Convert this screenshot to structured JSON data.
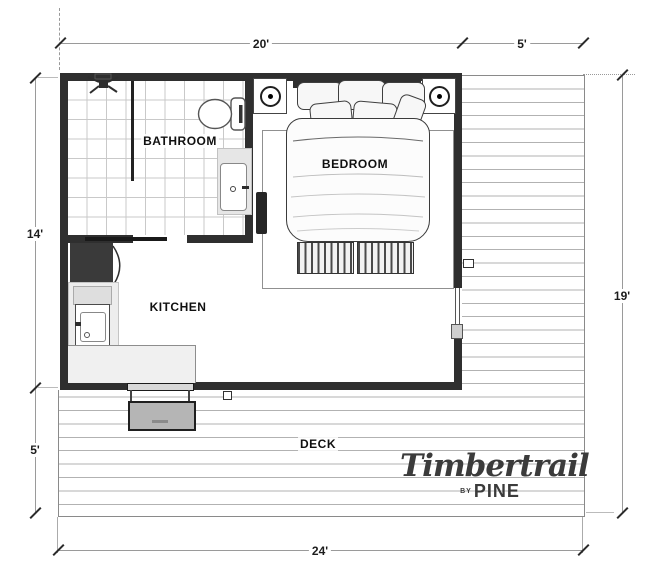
{
  "rooms": {
    "bathroom": "BATHROOM",
    "bedroom": "BEDROOM",
    "kitchen": "KITCHEN",
    "deck": "DECK"
  },
  "dimensions": {
    "top_width": "20'",
    "top_deck_width": "5'",
    "left_height": "14'",
    "left_deck_height": "5'",
    "right_height": "19'",
    "bottom_width": "24'"
  },
  "logo": {
    "brand": "Timbertrail",
    "by_label": "BY",
    "maker": "PINE"
  },
  "icons": {
    "shower": "shower-head-icon",
    "toilet": "toilet-icon",
    "bathroom_sink": "bathroom-sink-icon",
    "kitchen_sink": "kitchen-sink-icon",
    "refrigerator": "refrigerator",
    "bed": "double-bed",
    "lamp": "bedside-lamp-icon",
    "step": "entry-step"
  },
  "colors": {
    "wall": "#2f2f2f",
    "deck_line": "#b2b2b2",
    "dimension_line": "#9a9a9a",
    "label_text": "#101010",
    "logo_text": "#3b3b3b"
  }
}
